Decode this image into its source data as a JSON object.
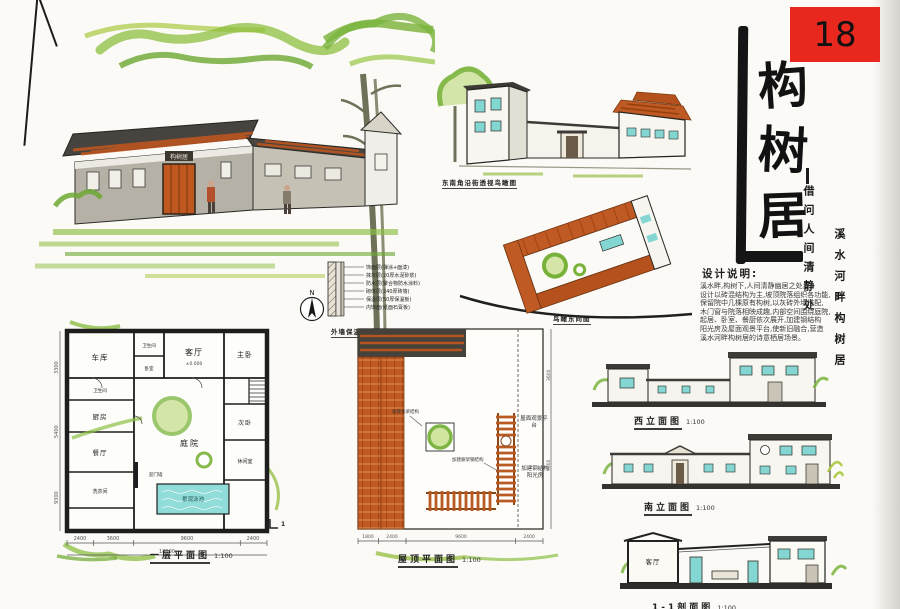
{
  "sheet": {
    "number": "18"
  },
  "title": {
    "chars": [
      "构",
      "树",
      "居"
    ],
    "subtitle_left": "借问人间清静处",
    "subtitle_right": "溪水河畔构树居"
  },
  "design_notes": {
    "heading": "设计说明:",
    "lines": [
      "溪水畔,构树下,人间清静幽居之处。",
      "设计以砖混结构为主,坡顶院落组织各功能,",
      "保留院中几棵原有构树,以灰砖外墙搭配,",
      "木门窗与院落相映成趣,内部空间围绕庭院,",
      "起居、卧室、餐厨依次展开,加建钢结构",
      "阳光房及屋面观景平台,使新旧融合,营造",
      "溪水河畔构树居的诗意栖居场景。"
    ]
  },
  "views": {
    "perspective_caption": "东南角沿街透视鸟瞰图",
    "axon_caption": "鸟瞰东向图",
    "house_sign": "构树居"
  },
  "floor_plan": {
    "caption": "一层平面图",
    "scale": "1:100",
    "rooms": {
      "garage": "车库",
      "bath1": "卫生间",
      "bed_small": "卧室",
      "bath2": "卫生间",
      "kitchen": "厨房",
      "dining": "餐厅",
      "laundry": "洗衣间",
      "living": "客厅",
      "master": "主卧",
      "courtyard": "庭院",
      "second_bed": "次卧",
      "leisure": "休闲室",
      "screen_wall": "迎门墙",
      "pool": "景观泳池"
    },
    "level_living": "±0.000",
    "dims_bottom": [
      "2400",
      "3600",
      "9600",
      "2400"
    ],
    "dims_total": "18000",
    "dims_left": [
      "3300",
      "5400",
      "9300"
    ],
    "section_mark": "1"
  },
  "north": {
    "label": "N"
  },
  "wall_detail": {
    "caption": "外墙保温构造",
    "scale": "1:20",
    "notes": [
      "饰面层(弹涂+面漆)",
      "抹灰层(20厚水泥砂浆)",
      "防水层(聚合物防水涂料)",
      "砌体层(240厚砖墙)",
      "保温层(50厚保温板)",
      "内饰面(纸面石膏板)"
    ]
  },
  "roof_plan": {
    "caption": "屋顶平面图",
    "scale": "1:100",
    "notes": {
      "timber": "加建木梁结构",
      "pergola": "加建廊架钢结构",
      "deck": "屋面观景平台",
      "sunroom": "加建钢结构阳光房"
    },
    "dims_bottom": [
      "1800",
      "2400",
      "9600",
      "2400"
    ],
    "dims_right": [
      "3600",
      "9000"
    ]
  },
  "elevations": {
    "west": {
      "caption": "西立面图",
      "scale": "1:100"
    },
    "south": {
      "caption": "南立面图",
      "scale": "1:100"
    },
    "section": {
      "caption": "1-1剖面图",
      "scale": "1:100",
      "room": "客厅"
    }
  },
  "colors": {
    "accent_red": "#e8281e",
    "roof_orange": "#c05a24",
    "leaf_green": "#7ab43e",
    "cyan": "#84d6d2",
    "ink": "#1c1c1c"
  }
}
